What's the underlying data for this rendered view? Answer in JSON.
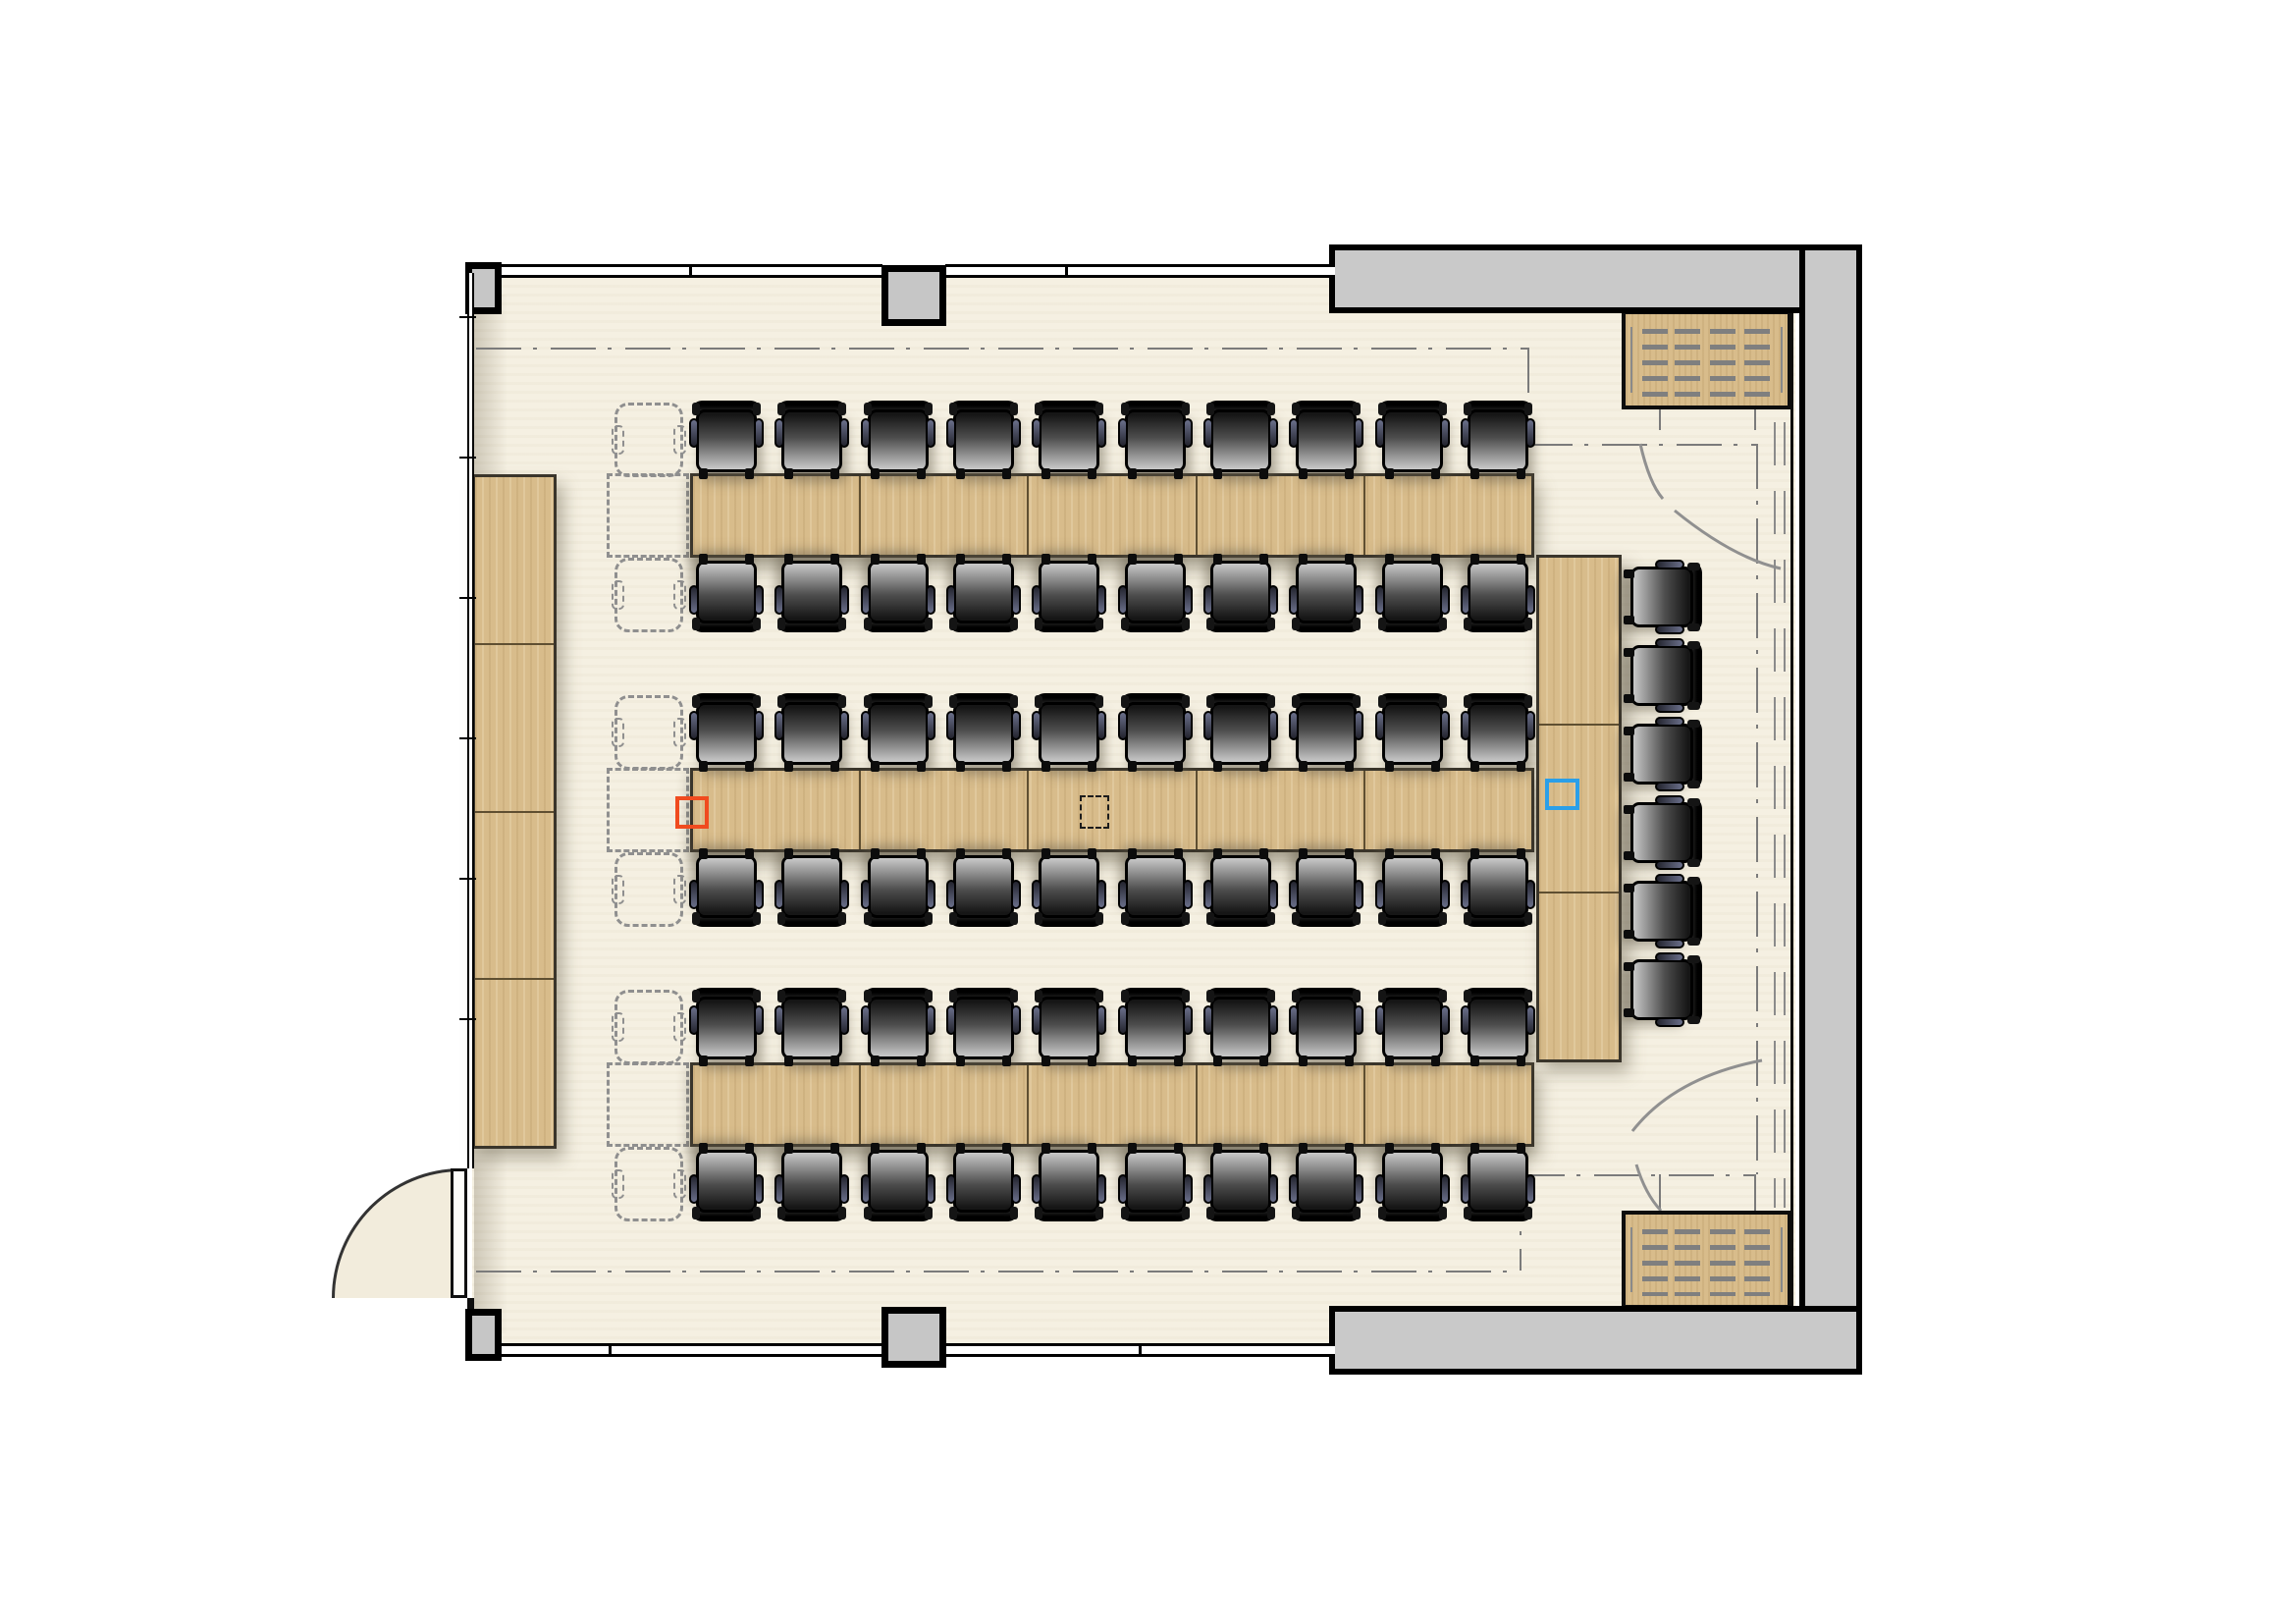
{
  "page": {
    "title": "Seminar room floor plan",
    "type": "architectural-floor-plan",
    "text_labels": []
  },
  "colors": {
    "floor": "#f5f0e2",
    "exterior": "#ffffff",
    "wall_black": "#0d0d0d",
    "wall_gray_fill": "#c9c9c9",
    "column_fill": "#c6c6c6",
    "wood": "#d8bc8b",
    "wood_dark_edge": "#3a352b",
    "chair_dark": "#161616",
    "chair_light": "#c9c9c9",
    "ghost_gray": "#8f8f8f",
    "dashdot_gray": "#7b7b7b",
    "marker_orange": "#f04b1f",
    "marker_blue": "#2b9fe8",
    "marker_black": "#1c1c1c"
  },
  "furniture": {
    "table_rows": [
      {
        "id": "A",
        "segments": 5
      },
      {
        "id": "B",
        "segments": 5
      },
      {
        "id": "C",
        "segments": 5
      }
    ],
    "chair_rows": [
      {
        "row": 1,
        "chairs": 10,
        "facing": "south"
      },
      {
        "row": 2,
        "chairs": 10,
        "facing": "north"
      },
      {
        "row": 3,
        "chairs": 10,
        "facing": "south"
      },
      {
        "row": 4,
        "chairs": 10,
        "facing": "north"
      },
      {
        "row": 5,
        "chairs": 10,
        "facing": "south"
      },
      {
        "row": 6,
        "chairs": 10,
        "facing": "north"
      }
    ],
    "side_table": {
      "segments": 3,
      "chairs": 6,
      "chair_facing": "west"
    },
    "sideboard": {
      "segments": 4
    },
    "ghost_chairs": {
      "count": 6,
      "style": "dashed-outline"
    },
    "ghost_table_extensions": {
      "count": 3,
      "style": "dashed-outline"
    },
    "radiators": {
      "count": 2,
      "locations": [
        "top-right",
        "bottom-right"
      ]
    }
  },
  "architecture": {
    "windows": {
      "count": 4,
      "locations": [
        "top-left",
        "top-right",
        "bottom-left",
        "bottom-right"
      ]
    },
    "columns": {
      "count": 4
    },
    "door": {
      "count": 1,
      "location": "bottom-left",
      "swing": "outward"
    },
    "movable_partition": {
      "location": "right",
      "style": "dashed-stack-track"
    },
    "boundary_line": {
      "style": "dash-dot",
      "shape": "inset-perimeter"
    }
  },
  "markers": [
    {
      "id": "marker-orange",
      "shape": "square-outline",
      "color_key": "marker_orange",
      "location": "left-end-of-middle-table"
    },
    {
      "id": "marker-blue",
      "shape": "square-outline",
      "color_key": "marker_blue",
      "location": "right-side-table"
    },
    {
      "id": "marker-black-dashed",
      "shape": "square-dashed-outline",
      "color_key": "marker_black",
      "location": "center-of-middle-table"
    }
  ]
}
